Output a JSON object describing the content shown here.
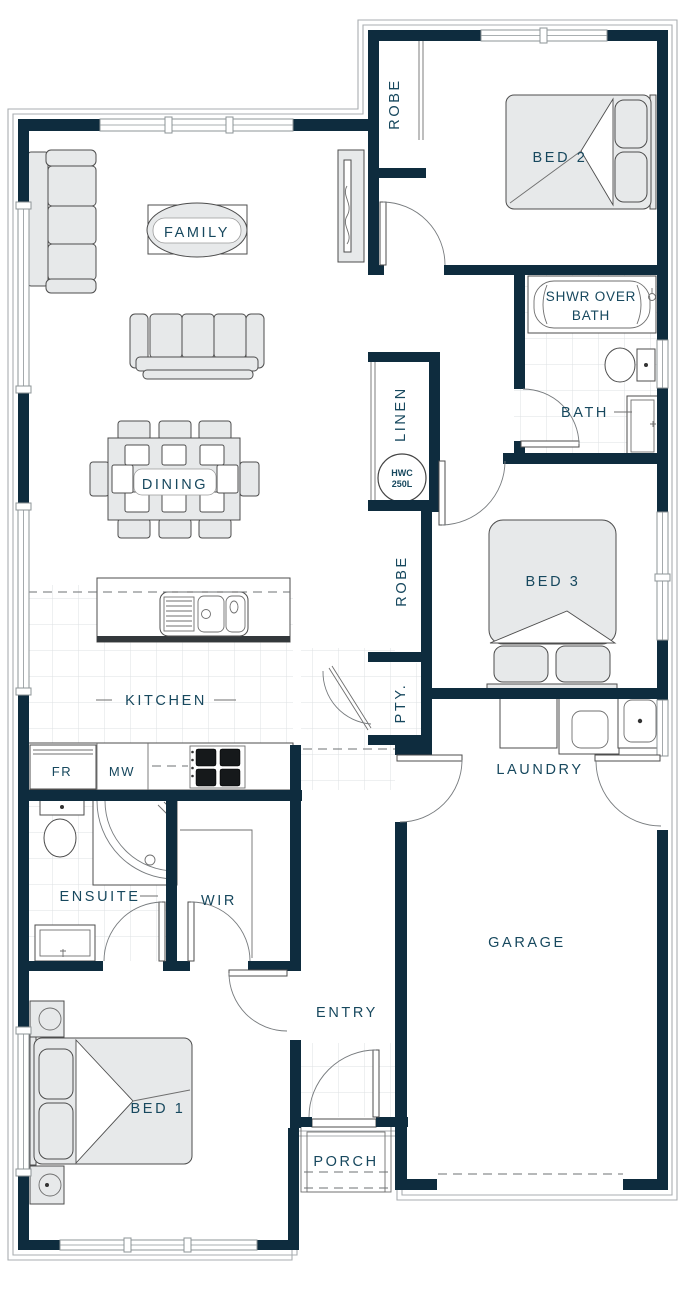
{
  "plan": {
    "type": "residential-floor-plan",
    "colors": {
      "wall": "#0e2c3e",
      "label_text": "#17485e",
      "furniture_fill": "#e7e9ea",
      "tile_line": "#dde1e3",
      "outline": "#a9aeb1"
    },
    "rooms": {
      "family": {
        "label": "FAMILY"
      },
      "dining": {
        "label": "DINING"
      },
      "kitchen": {
        "label": "KITCHEN"
      },
      "bed1": {
        "label": "BED 1"
      },
      "bed2": {
        "label": "BED 2"
      },
      "bed3": {
        "label": "BED 3"
      },
      "bath": {
        "label": "BATH"
      },
      "ensuite": {
        "label": "ENSUITE"
      },
      "wir": {
        "label": "WIR"
      },
      "linen": {
        "label": "LINEN"
      },
      "robe_top": {
        "label": "ROBE"
      },
      "robe_mid": {
        "label": "ROBE"
      },
      "pantry": {
        "label": "PTY."
      },
      "laundry": {
        "label": "LAUNDRY"
      },
      "garage": {
        "label": "GARAGE"
      },
      "entry": {
        "label": "ENTRY"
      },
      "porch": {
        "label": "PORCH"
      }
    },
    "fixtures": {
      "shower_over_bath_line1": "SHWR OVER",
      "shower_over_bath_line2": "BATH",
      "hwc_line1": "HWC",
      "hwc_line2": "250L",
      "fridge": "FR",
      "microwave": "MW"
    }
  }
}
